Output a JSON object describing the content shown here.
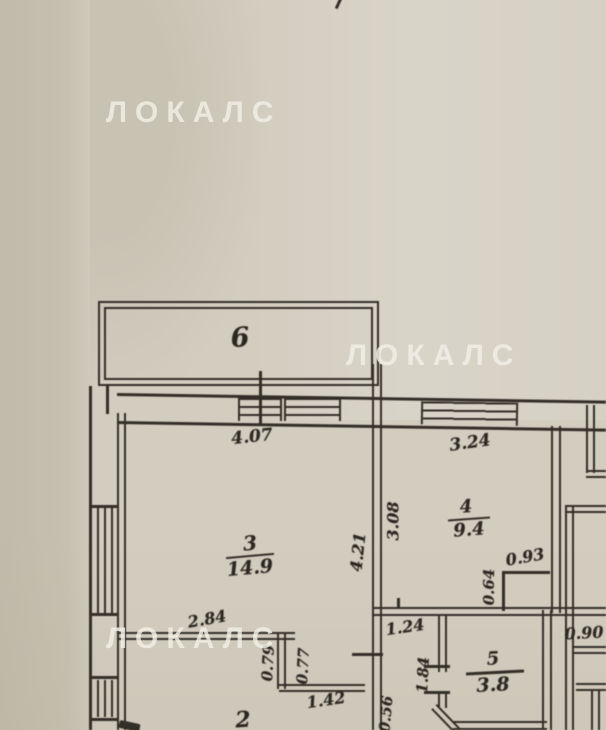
{
  "watermark": {
    "text": "ЛОКАЛС"
  },
  "rooms": {
    "r6": {
      "number": "6"
    },
    "r3": {
      "number": "3",
      "area": "14.9"
    },
    "r4": {
      "number": "4",
      "area": "9.4"
    },
    "r5": {
      "number": "5",
      "area": "3.8"
    },
    "r2": {
      "number": "2"
    }
  },
  "dims": {
    "d4_07": "4.07",
    "d3_24": "3.24",
    "d3_08": "3.08",
    "d4_21": "4.21",
    "d2_84": "2.84",
    "d0_93": "0.93",
    "d0_64": "0.64",
    "d0_79": "0.79",
    "d0_77": "0.77",
    "d1_42": "1.42",
    "d1_24": "1.24",
    "d1_84": "1.84",
    "d0_56": "0.56",
    "d0_90": "0.90"
  },
  "colors": {
    "paper": "#d3cdc0",
    "paper_dark_strip": "#c1bbab",
    "plan_line": "#332f28",
    "ink": "#2b2721",
    "watermark": "rgba(242,239,231,0.82)"
  }
}
